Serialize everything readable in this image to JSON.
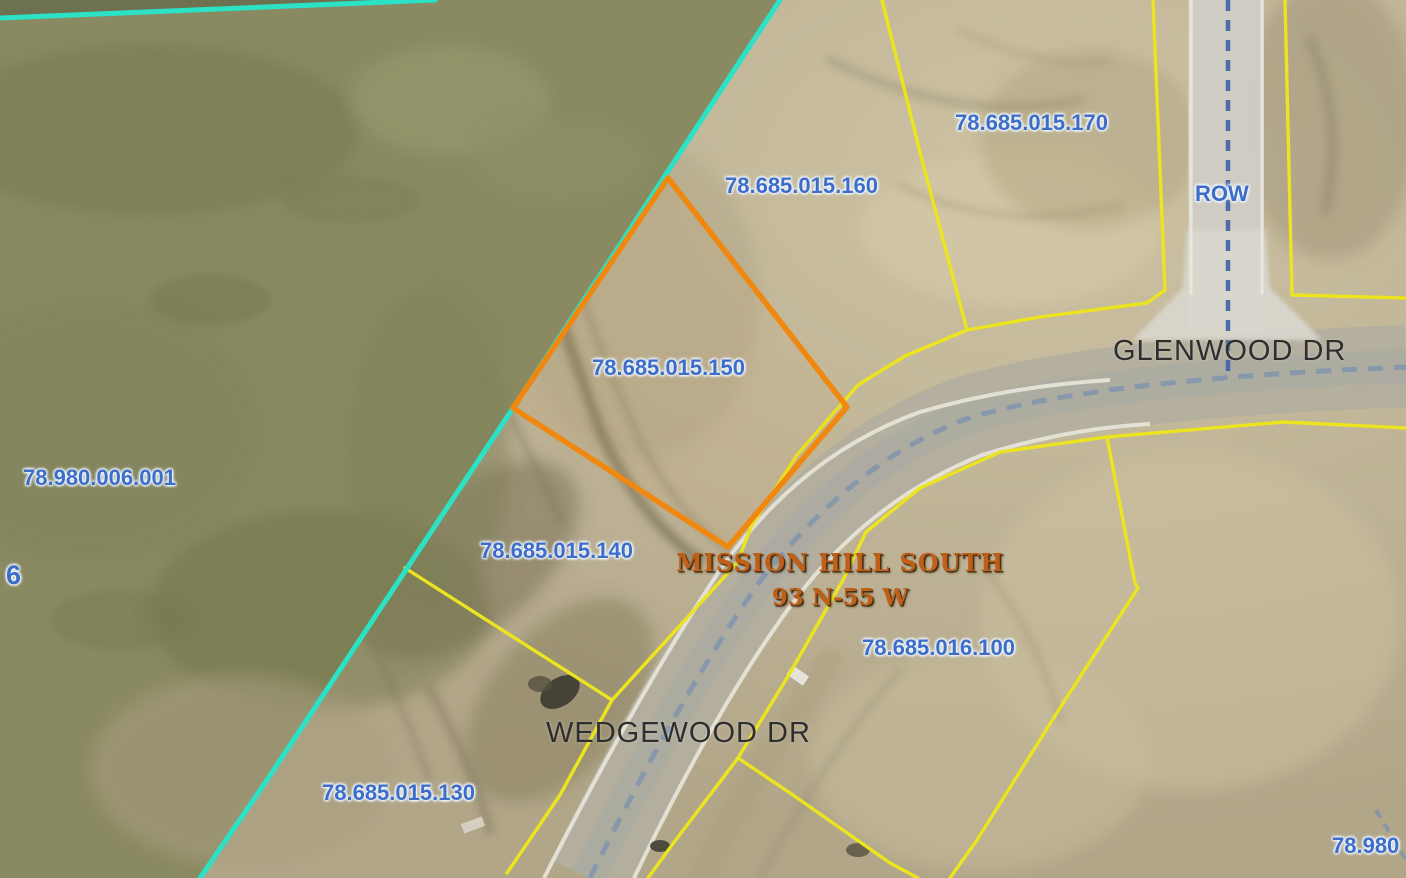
{
  "map": {
    "highlighted_parcel_id": "78.685.015.150",
    "parcel_labels": {
      "p170": "78.685.015.170",
      "p160": "78.685.015.160",
      "p150": "78.685.015.150",
      "p140": "78.685.015.140",
      "p130": "78.685.015.130",
      "p016100": "78.685.016.100",
      "p980006001": "78.980.006.001",
      "p980_partial": "78.980",
      "section": "6",
      "row": "ROW"
    },
    "road_labels": {
      "glenwood": "GLENWOOD DR",
      "wedgewood": "WEDGEWOOD DR"
    },
    "plat_label": {
      "name": "MISSION HILL SOUTH",
      "township_range": "93 N-55 W"
    },
    "colors": {
      "parcel_line": "#ece41e",
      "selected_parcel_outline": "#f0870f",
      "plat_boundary_line": "#2be2c6",
      "parcel_label_text": "#3d6dc8",
      "plat_label_text": "#c05f17",
      "road_label_text": "#2e2e31",
      "road_centerline_dash": "#8396ab"
    }
  }
}
